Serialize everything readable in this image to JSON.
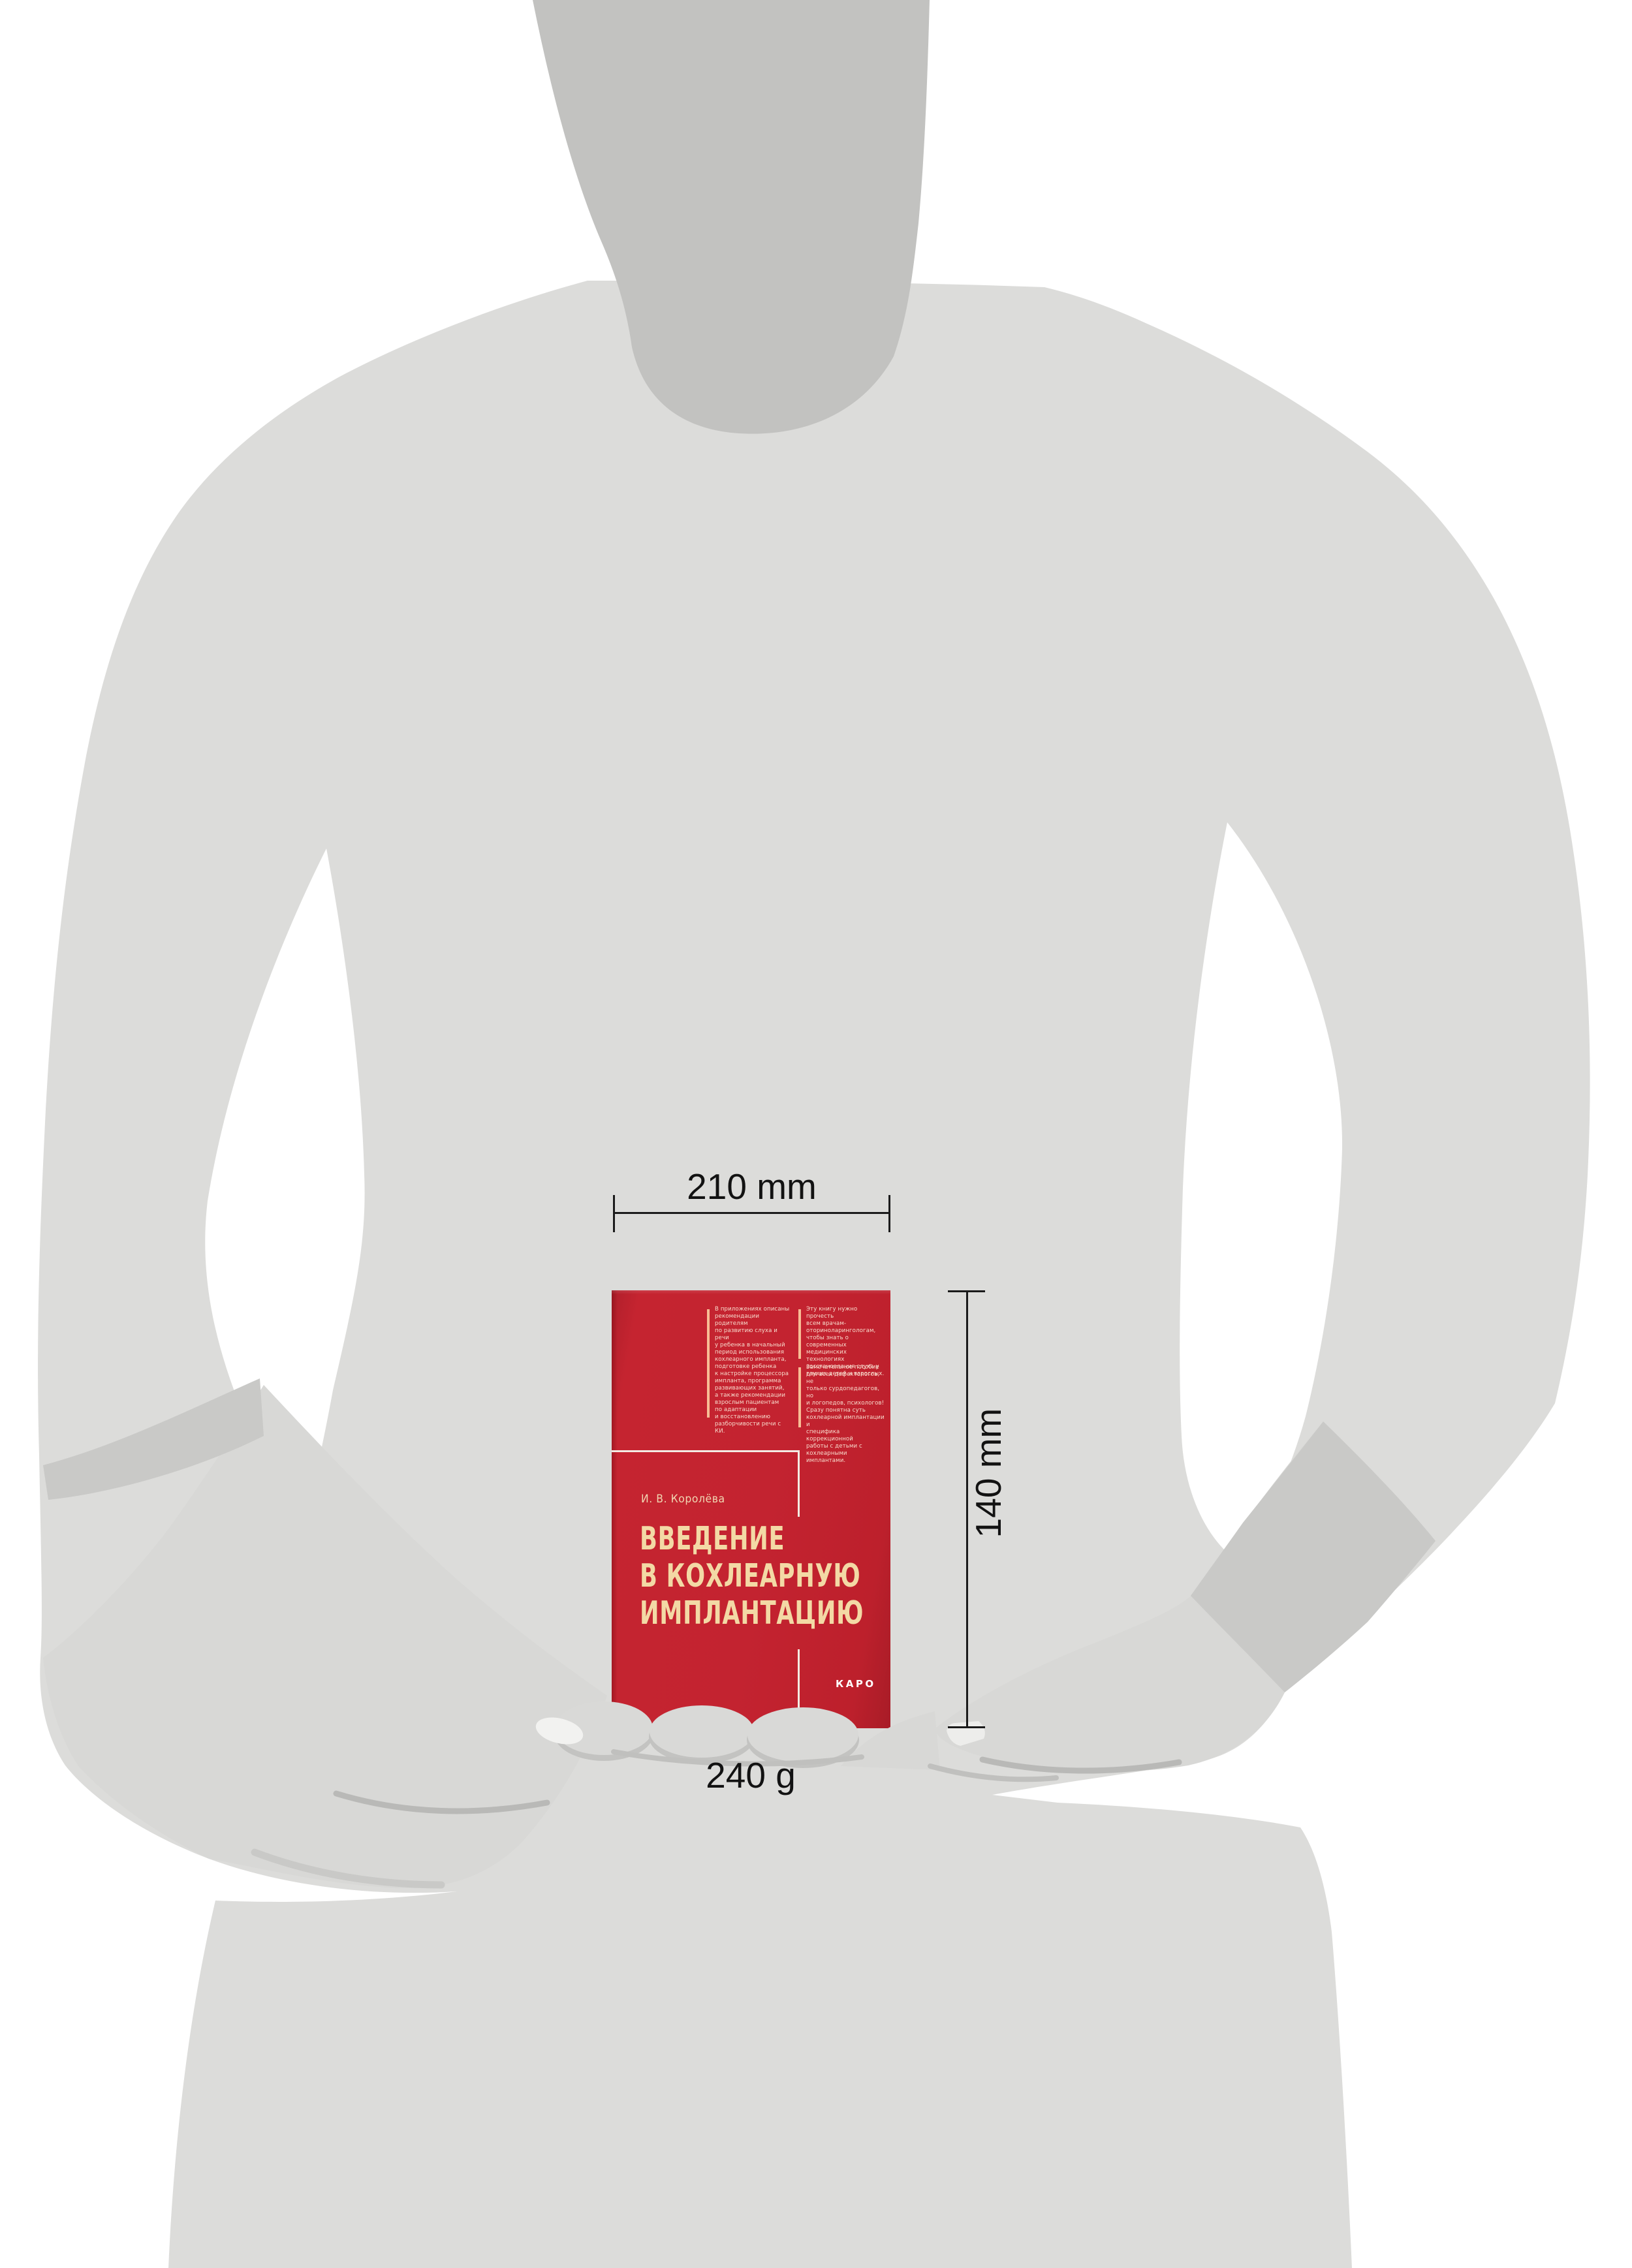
{
  "book": {
    "author": "И. В. Королёва",
    "title_lines": [
      "ВВЕДЕНИЕ",
      "В КОХЛЕАРНУЮ",
      "ИМПЛАНТАЦИЮ"
    ],
    "publisher": "КАРО",
    "back_blurb_left": "В приложениях описаны\nрекомендации родителям\nпо развитию слуха и речи\nу ребенка в начальный\nпериод использования\nкохлеарного импланта,\nподготовке ребенка\nк настройке процессора\nимпланта, программа\nразвивающих занятий,\nа также рекомендации\nвзрослым пациентам\nпо адаптации\nи восстановлению\nразборчивости речи с КИ.",
    "back_blurb_right_1": "Эту книгу нужно прочесть\nвсем врачам-\nоториноларингологам,\nчтобы знать о современных\nмедицинских технологиях\nвосстановления слуха у\nглухих детей и взрослых.",
    "back_blurb_right_2": "Замечательное пособие\nдля всех дефектологов, не\nтолько сурдопедагогов, но\nи логопедов, психологов!\nСразу понятна суть\nкохлеарной имплантации и\nспецифика коррекционной\nработы с детьми с\nкохлеарными имплантами."
  },
  "dimensions": {
    "width_label": "210 mm",
    "height_label": "140 mm",
    "weight_label": "240 g"
  },
  "colors": {
    "background": "#ffffff",
    "body_gray": "#dcdcda",
    "neck_gray": "#c2c2c0",
    "cuff_gray": "#c9c9c7",
    "hand_gray": "#d8d8d6",
    "book_red": "#c32330",
    "title_cream": "#f3d9a5",
    "accent_peach": "#f8bd95",
    "blurb_pink": "#f8dccd",
    "frame_white": "#f3eae2",
    "dim_black": "#1b1b1b"
  }
}
